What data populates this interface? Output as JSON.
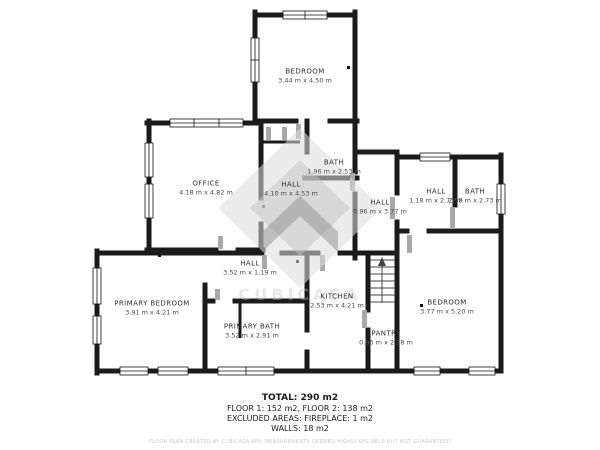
{
  "rooms": [
    {
      "name": "BEDROOM",
      "dims": "3.44 m x 4.50 m"
    },
    {
      "name": "OFFICE",
      "dims": "4.18 m x 4.82 m"
    },
    {
      "name": "BATH",
      "dims": "1.96 m x 2.53 m"
    },
    {
      "name": "HALL",
      "dims": "4.10 m x 4.53 m"
    },
    {
      "name": "HALL",
      "dims": "0.96 m x 3.77 m"
    },
    {
      "name": "HALL",
      "dims": "1.18 m x 2.73 m"
    },
    {
      "name": "BATH",
      "dims": "2.58 m x 2.73 m"
    },
    {
      "name": "PRIMARY BEDROOM",
      "dims": "3.91 m x 4.21 m"
    },
    {
      "name": "HALL",
      "dims": "3.52 m x 1.19 m"
    },
    {
      "name": "PRIMARY BATH",
      "dims": "3.52 m x 2.91 m"
    },
    {
      "name": "KITCHEN",
      "dims": "2.53 m x 4.21 m"
    },
    {
      "name": "PANTRY",
      "dims": "0.96 m x 2.18 m"
    },
    {
      "name": "BEDROOM",
      "dims": "3.77 m x 5.20 m"
    }
  ],
  "footer": {
    "total": "TOTAL: 290 m2",
    "floors": "FLOOR 1: 152 m2, FLOOR 2: 138 m2",
    "excluded": "EXCLUDED AREAS: FIREPLACE: 1 m2",
    "walls": "WALLS: 18 m2",
    "disclaimer": "FLOOR PLAN CREATED BY CUBICASA APP. MEASUREMENTS DEEMED HIGHLY RELIABLE BUT NOT GUARANTEED"
  },
  "watermark": {
    "label": "CUBICASA"
  },
  "colors": {
    "wall": "#1b1b1b",
    "door": "#a8a8a8",
    "watermark": "#d9d9d9",
    "background": "#ffffff"
  }
}
